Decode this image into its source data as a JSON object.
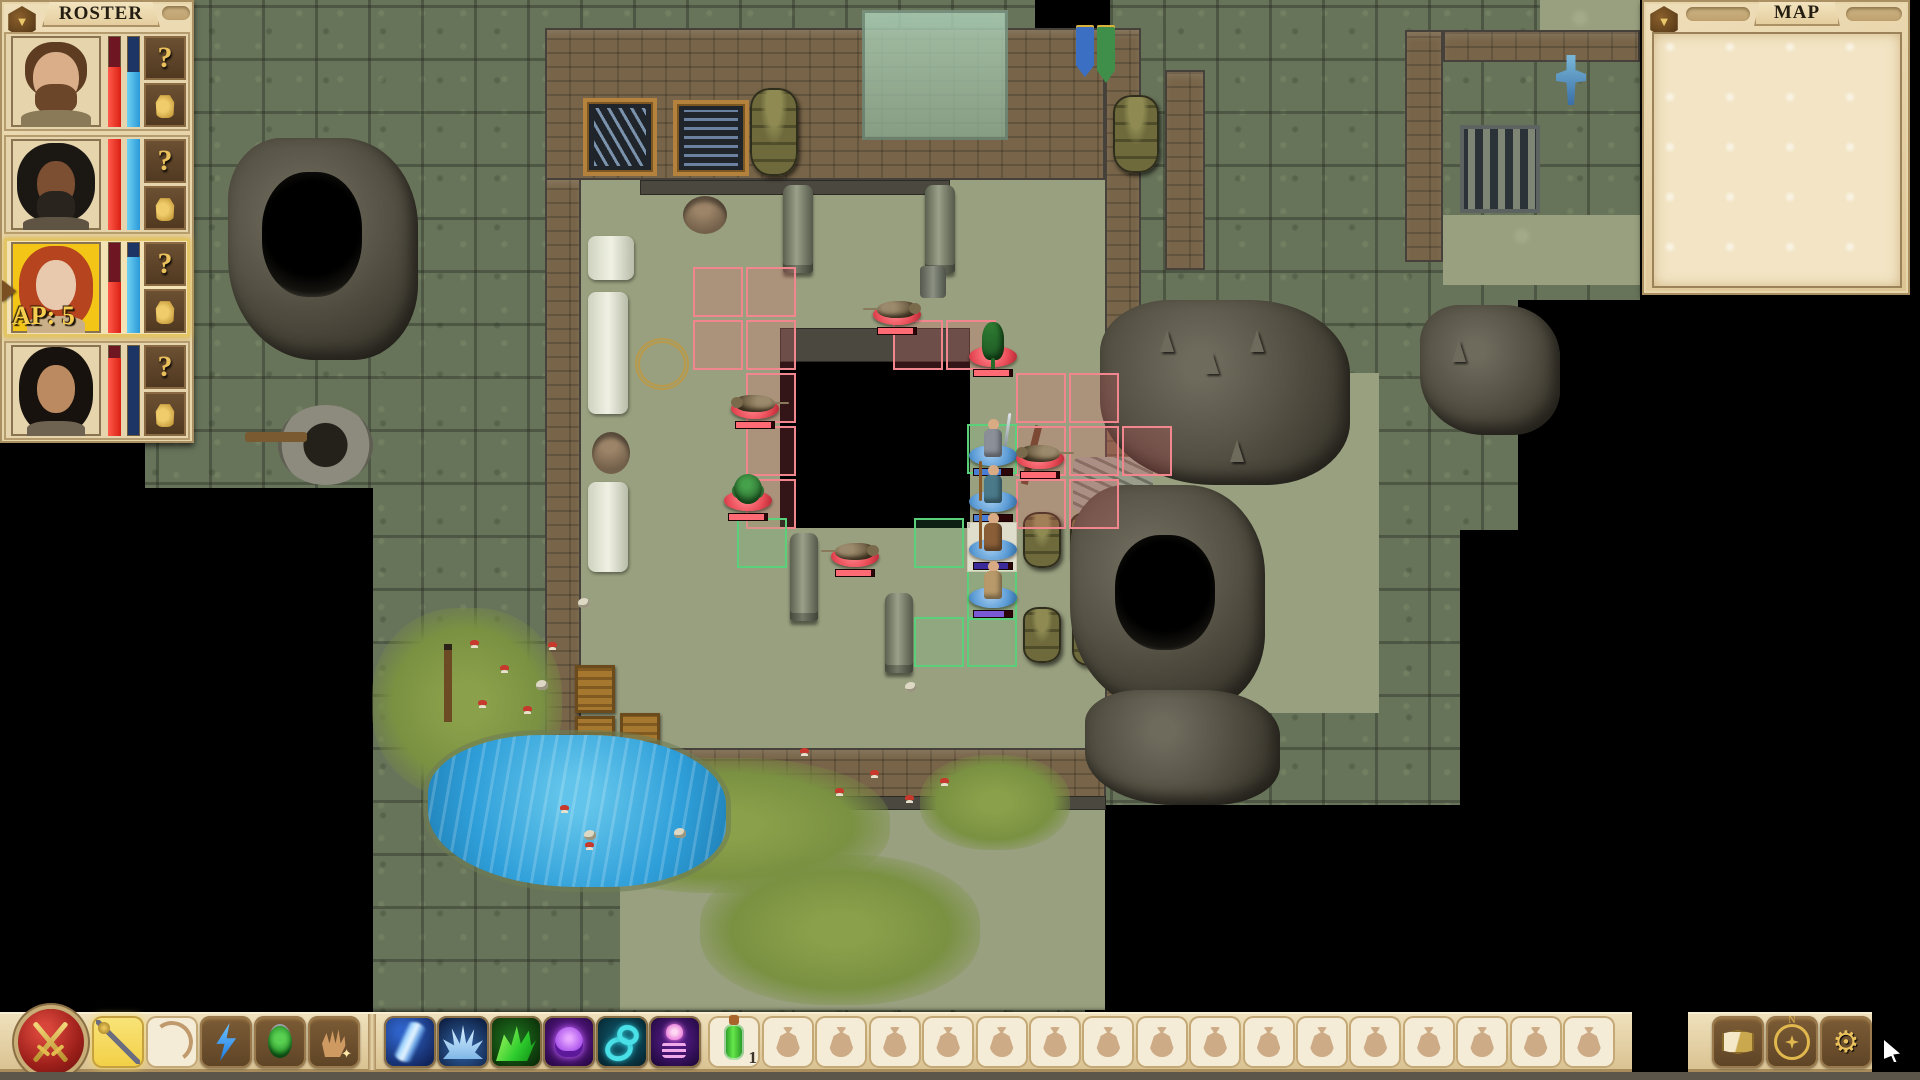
{
  "roster": {
    "title": "ROSTER",
    "collapse_icon": "▼",
    "info_label": "?",
    "ap_color": "#f6cd4e",
    "characters": [
      {
        "id": "c1",
        "desc": "bearded brown-haired man",
        "hp": 66,
        "sp": 60,
        "selected": false,
        "ap": ""
      },
      {
        "id": "c2",
        "desc": "dark-skinned long-haired man",
        "hp": 100,
        "sp": 100,
        "selected": false,
        "ap": ""
      },
      {
        "id": "c3",
        "desc": "red-haired woman",
        "hp": 56,
        "sp": 84,
        "selected": true,
        "ap": "AP: 5"
      },
      {
        "id": "c4",
        "desc": "black-haired woman",
        "hp": 86,
        "sp": 0,
        "selected": false,
        "ap": ""
      }
    ]
  },
  "map_panel": {
    "title": "MAP",
    "collapse_icon": "▼",
    "minimap": {
      "rooms": [
        [
          24,
          52,
          44,
          28
        ],
        [
          88,
          130,
          8,
          14
        ]
      ],
      "walls": [
        [
          20,
          48,
          52,
          4
        ],
        [
          18,
          48,
          4,
          40
        ],
        [
          18,
          84,
          16,
          4
        ],
        [
          32,
          88,
          4,
          16
        ],
        [
          32,
          100,
          22,
          4
        ],
        [
          52,
          100,
          4,
          10
        ],
        [
          70,
          48,
          4,
          16
        ],
        [
          72,
          60,
          18,
          4
        ],
        [
          88,
          60,
          4,
          18
        ],
        [
          66,
          74,
          26,
          4
        ],
        [
          12,
          106,
          4,
          58
        ],
        [
          12,
          160,
          12,
          4
        ],
        [
          22,
          162,
          4,
          34
        ],
        [
          24,
          192,
          12,
          4
        ],
        [
          94,
          76,
          4,
          22
        ],
        [
          96,
          94,
          16,
          4
        ],
        [
          110,
          96,
          4,
          26
        ],
        [
          104,
          118,
          8,
          4
        ],
        [
          112,
          120,
          4,
          34
        ],
        [
          104,
          150,
          10,
          4
        ],
        [
          96,
          152,
          4,
          28
        ],
        [
          86,
          176,
          12,
          4
        ],
        [
          86,
          178,
          4,
          24
        ],
        [
          74,
          198,
          14,
          4
        ],
        [
          34,
          194,
          4,
          30
        ],
        [
          36,
          220,
          12,
          4
        ],
        [
          46,
          222,
          4,
          24
        ],
        [
          48,
          242,
          14,
          4
        ],
        [
          60,
          222,
          4,
          22
        ],
        [
          74,
          218,
          4,
          26
        ]
      ],
      "viewport": [
        36,
        126,
        42,
        44
      ],
      "view_block": [
        50,
        132,
        18,
        16
      ],
      "enemy_marks": [
        [
          48,
          136
        ],
        [
          58,
          128
        ],
        [
          66,
          132
        ],
        [
          48,
          144
        ],
        [
          56,
          150
        ],
        [
          68,
          142
        ]
      ],
      "party_marks": [
        [
          69,
          140
        ],
        [
          69,
          145
        ],
        [
          69,
          150
        ],
        [
          69,
          155
        ]
      ],
      "water": [
        32,
        178,
        40,
        32
      ]
    }
  },
  "toolbar": {
    "weapon_slots": [
      {
        "name": "staff",
        "style": "selected"
      },
      {
        "name": "bow",
        "style": "pale"
      },
      {
        "name": "lightning-bolt",
        "style": "brown"
      },
      {
        "name": "beetle-charm",
        "style": "brown"
      },
      {
        "name": "mage-hand",
        "style": "brown"
      }
    ],
    "spell_slots": [
      {
        "name": "chain-lightning",
        "style": "dark1"
      },
      {
        "name": "ice-crystals",
        "style": "dark2"
      },
      {
        "name": "acid-spray",
        "style": "dark3"
      },
      {
        "name": "curse-skull",
        "style": "dark4"
      },
      {
        "name": "shackles",
        "style": "dark5"
      },
      {
        "name": "summon-skeleton",
        "style": "dark6"
      }
    ],
    "item_slots": [
      {
        "name": "green-potion",
        "count": "1"
      }
    ],
    "bag_slot_count": 16,
    "system_buttons": [
      {
        "name": "journal"
      },
      {
        "name": "compass",
        "n": "N"
      },
      {
        "name": "settings",
        "glyph": "⚙"
      }
    ]
  },
  "battle": {
    "enemies": [
      {
        "type": "rat",
        "x": 897,
        "y": 318,
        "flip": false
      },
      {
        "type": "lizard",
        "x": 993,
        "y": 360,
        "flip": false
      },
      {
        "type": "rat",
        "x": 755,
        "y": 412,
        "flip": true
      },
      {
        "type": "beetle",
        "x": 748,
        "y": 504,
        "flip": false
      },
      {
        "type": "rat",
        "x": 855,
        "y": 560,
        "flip": false
      },
      {
        "type": "rat",
        "x": 1040,
        "y": 462,
        "flip": true
      }
    ],
    "party": [
      {
        "type": "fighter",
        "x": 993,
        "y": 461,
        "hp": 70,
        "hpcolor": "#4a7dd4",
        "suit": "#8a8f98",
        "active": false
      },
      {
        "type": "ranger",
        "x": 993,
        "y": 507,
        "hp": 60,
        "hpcolor": "#4a7dd4",
        "suit": "#4a7a8a",
        "active": false
      },
      {
        "type": "mage",
        "x": 993,
        "y": 555,
        "hp": 90,
        "hpcolor": "#3a2a9a",
        "suit": "#8a5f38",
        "active": true
      },
      {
        "type": "priest",
        "x": 993,
        "y": 603,
        "hp": 80,
        "hpcolor": "#7a5ad4",
        "suit": "#b89a6a",
        "active": false
      }
    ],
    "red_tiles": [
      [
        693,
        267
      ],
      [
        746,
        267
      ],
      [
        693,
        320
      ],
      [
        746,
        320
      ],
      [
        746,
        373
      ],
      [
        746,
        426
      ],
      [
        746,
        479
      ],
      [
        893,
        320
      ],
      [
        946,
        320
      ],
      [
        1016,
        373
      ],
      [
        1069,
        373
      ],
      [
        1016,
        426
      ],
      [
        1069,
        426
      ],
      [
        1016,
        479
      ],
      [
        1069,
        479
      ],
      [
        1122,
        426
      ]
    ],
    "green_tiles": [
      [
        967,
        424
      ],
      [
        914,
        518
      ],
      [
        967,
        570
      ],
      [
        914,
        617
      ],
      [
        967,
        617
      ],
      [
        737,
        518
      ]
    ],
    "active_tile": [
      967,
      522
    ]
  }
}
